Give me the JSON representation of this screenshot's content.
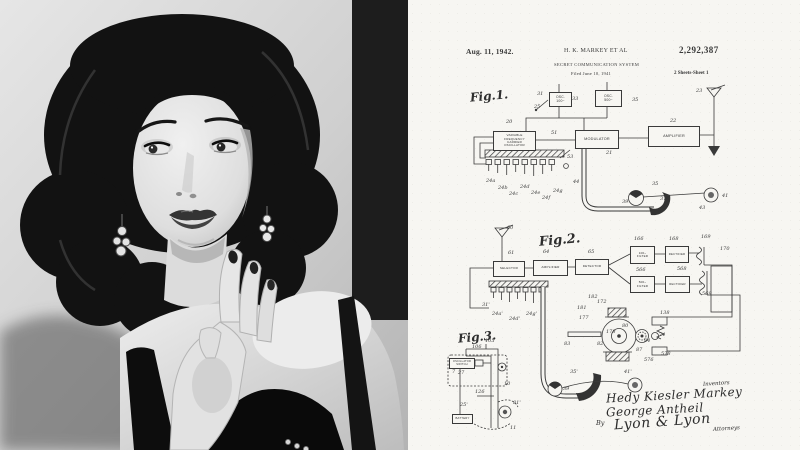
{
  "portrait": {
    "description_label": "black-and-white studio portrait",
    "palette": {
      "wall_light": "#e3e3e3",
      "wall_mid": "#cfcfcf",
      "drape_dark": "#1d1d1d",
      "hair": "#121212",
      "skin_light": "#f0f0f0",
      "skin_shadow": "#c2c2c2",
      "dress": "#0a0a0a"
    }
  },
  "patent": {
    "paper_color": "#f7f6f2",
    "ink_color": "#3a3a3a",
    "header": {
      "date": "Aug. 11, 1942.",
      "inventor": "H. K. MARKEY ET AL",
      "patent_number": "2,292,387",
      "title": "SECRET COMMUNICATION SYSTEM",
      "filed": "Filed June 10, 1941",
      "sheet": "2 Sheets-Sheet 1"
    },
    "figure_labels": [
      {
        "text": "Fig.1.",
        "x": 62,
        "y": 89,
        "fs": 12
      },
      {
        "text": "Fig.2.",
        "x": 131,
        "y": 233,
        "fs": 13
      },
      {
        "text": "Fig.3.",
        "x": 50,
        "y": 330,
        "fs": 12
      }
    ],
    "boxes": [
      {
        "id": "variable-frequency-carrier-oscillator",
        "x": 85,
        "y": 131,
        "w": 41,
        "h": 18,
        "fs": 3,
        "lines": [
          "VARIABLE",
          "FREQUENCY",
          "CARRIER",
          "OSCILLATOR"
        ]
      },
      {
        "id": "osc-100",
        "x": 141,
        "y": 92,
        "w": 21,
        "h": 13,
        "fs": 3.4,
        "lines": [
          "OSC.",
          "100~"
        ]
      },
      {
        "id": "osc-500",
        "x": 187,
        "y": 90,
        "w": 25,
        "h": 15,
        "fs": 3.4,
        "lines": [
          "OSC.",
          "500~"
        ]
      },
      {
        "id": "modulator",
        "x": 167,
        "y": 130,
        "w": 42,
        "h": 17,
        "fs": 3.8,
        "lines": [
          "MODULATOR"
        ]
      },
      {
        "id": "amplifier-fig1",
        "x": 240,
        "y": 126,
        "w": 50,
        "h": 19,
        "fs": 3.8,
        "lines": [
          "AMPLIFIER"
        ]
      },
      {
        "id": "selector",
        "x": 85,
        "y": 261,
        "w": 30,
        "h": 14,
        "fs": 3.1,
        "lines": [
          "SELECTOR"
        ]
      },
      {
        "id": "amplifier-fig2",
        "x": 125,
        "y": 260,
        "w": 33,
        "h": 14,
        "fs": 3.1,
        "lines": [
          "AMPLIFIER"
        ]
      },
      {
        "id": "detector",
        "x": 167,
        "y": 259,
        "w": 32,
        "h": 14,
        "fs": 3.1,
        "lines": [
          "DETECTOR"
        ]
      },
      {
        "id": "filter-100",
        "x": 222,
        "y": 246,
        "w": 23,
        "h": 16,
        "fs": 3,
        "lines": [
          "100~",
          "FILTER"
        ]
      },
      {
        "id": "rectifier-upper",
        "x": 257,
        "y": 246,
        "w": 22,
        "h": 15,
        "fs": 2.8,
        "lines": [
          "RECTIFIER"
        ]
      },
      {
        "id": "filter-500",
        "x": 222,
        "y": 276,
        "w": 23,
        "h": 15,
        "fs": 3,
        "lines": [
          "500~",
          "FILTER"
        ]
      },
      {
        "id": "rectifier-lower",
        "x": 257,
        "y": 276,
        "w": 23,
        "h": 15,
        "fs": 2.8,
        "lines": [
          "RECTIFIER"
        ]
      },
      {
        "id": "oscillator-fig3",
        "x": 41,
        "y": 358,
        "w": 24,
        "h": 9,
        "fs": 2.6,
        "lines": [
          "OSCILLATOR",
          "SWITCH"
        ]
      },
      {
        "id": "battery-fig3",
        "x": 44,
        "y": 414,
        "w": 19,
        "h": 8,
        "fs": 2.8,
        "lines": [
          "BATTERY"
        ]
      }
    ],
    "numerals": [
      {
        "t": "23",
        "x": 288,
        "y": 88
      },
      {
        "t": "31",
        "x": 129,
        "y": 91
      },
      {
        "t": "33",
        "x": 164,
        "y": 96
      },
      {
        "t": "35",
        "x": 224,
        "y": 97
      },
      {
        "t": "25",
        "x": 126,
        "y": 104
      },
      {
        "t": "20",
        "x": 98,
        "y": 119
      },
      {
        "t": "51",
        "x": 143,
        "y": 130
      },
      {
        "t": "21",
        "x": 198,
        "y": 150
      },
      {
        "t": "22",
        "x": 262,
        "y": 118
      },
      {
        "t": "53",
        "x": 159,
        "y": 154
      },
      {
        "t": "44",
        "x": 165,
        "y": 179
      },
      {
        "t": "24a",
        "x": 78,
        "y": 178
      },
      {
        "t": "24b",
        "x": 90,
        "y": 185
      },
      {
        "t": "24c",
        "x": 101,
        "y": 191
      },
      {
        "t": "24d",
        "x": 112,
        "y": 184
      },
      {
        "t": "24e",
        "x": 123,
        "y": 190
      },
      {
        "t": "24f",
        "x": 134,
        "y": 195
      },
      {
        "t": "24g",
        "x": 145,
        "y": 188
      },
      {
        "t": "35",
        "x": 244,
        "y": 181
      },
      {
        "t": "37",
        "x": 252,
        "y": 196
      },
      {
        "t": "39",
        "x": 214,
        "y": 199
      },
      {
        "t": "41",
        "x": 314,
        "y": 193
      },
      {
        "t": "43",
        "x": 291,
        "y": 205
      },
      {
        "t": "60",
        "x": 99,
        "y": 225
      },
      {
        "t": "61",
        "x": 100,
        "y": 250
      },
      {
        "t": "64",
        "x": 135,
        "y": 249
      },
      {
        "t": "65",
        "x": 180,
        "y": 249
      },
      {
        "t": "166",
        "x": 226,
        "y": 236
      },
      {
        "t": "168",
        "x": 261,
        "y": 236
      },
      {
        "t": "169",
        "x": 293,
        "y": 234
      },
      {
        "t": "170",
        "x": 312,
        "y": 246
      },
      {
        "t": "566",
        "x": 228,
        "y": 267
      },
      {
        "t": "568",
        "x": 269,
        "y": 266
      },
      {
        "t": "569",
        "x": 294,
        "y": 291
      },
      {
        "t": "31'",
        "x": 74,
        "y": 302
      },
      {
        "t": "24a'",
        "x": 84,
        "y": 311
      },
      {
        "t": "24d'",
        "x": 101,
        "y": 316
      },
      {
        "t": "24g'",
        "x": 118,
        "y": 311
      },
      {
        "t": "172",
        "x": 189,
        "y": 299
      },
      {
        "t": "182",
        "x": 180,
        "y": 294
      },
      {
        "t": "181",
        "x": 169,
        "y": 305
      },
      {
        "t": "177",
        "x": 171,
        "y": 315
      },
      {
        "t": "83",
        "x": 156,
        "y": 341
      },
      {
        "t": "82",
        "x": 189,
        "y": 341
      },
      {
        "t": "178",
        "x": 198,
        "y": 329
      },
      {
        "t": "80",
        "x": 214,
        "y": 323
      },
      {
        "t": "84",
        "x": 236,
        "y": 338
      },
      {
        "t": "87",
        "x": 228,
        "y": 347
      },
      {
        "t": "138",
        "x": 252,
        "y": 310
      },
      {
        "t": "74",
        "x": 251,
        "y": 332
      },
      {
        "t": "578",
        "x": 253,
        "y": 351
      },
      {
        "t": "576",
        "x": 236,
        "y": 357
      },
      {
        "t": "35'",
        "x": 162,
        "y": 369
      },
      {
        "t": "39",
        "x": 155,
        "y": 386
      },
      {
        "t": "41'",
        "x": 216,
        "y": 369
      },
      {
        "t": "105",
        "x": 77,
        "y": 338
      },
      {
        "t": "106",
        "x": 64,
        "y": 344
      },
      {
        "t": "126",
        "x": 67,
        "y": 389
      },
      {
        "t": "10",
        "x": 96,
        "y": 381
      },
      {
        "t": "25'",
        "x": 52,
        "y": 402
      },
      {
        "t": "81'",
        "x": 105,
        "y": 400
      },
      {
        "t": "11",
        "x": 102,
        "y": 425
      },
      {
        "t": "27",
        "x": 50,
        "y": 370
      },
      {
        "t": "7",
        "x": 44,
        "y": 369
      }
    ],
    "signature": {
      "inventors_label": "Inventors",
      "inventor1": "Hedy Kiesler Markey",
      "inventor2": "George Antheil",
      "by_label": "By",
      "attorney_firm": "Lyon & Lyon",
      "attorneys_label": "Attorneys"
    }
  }
}
